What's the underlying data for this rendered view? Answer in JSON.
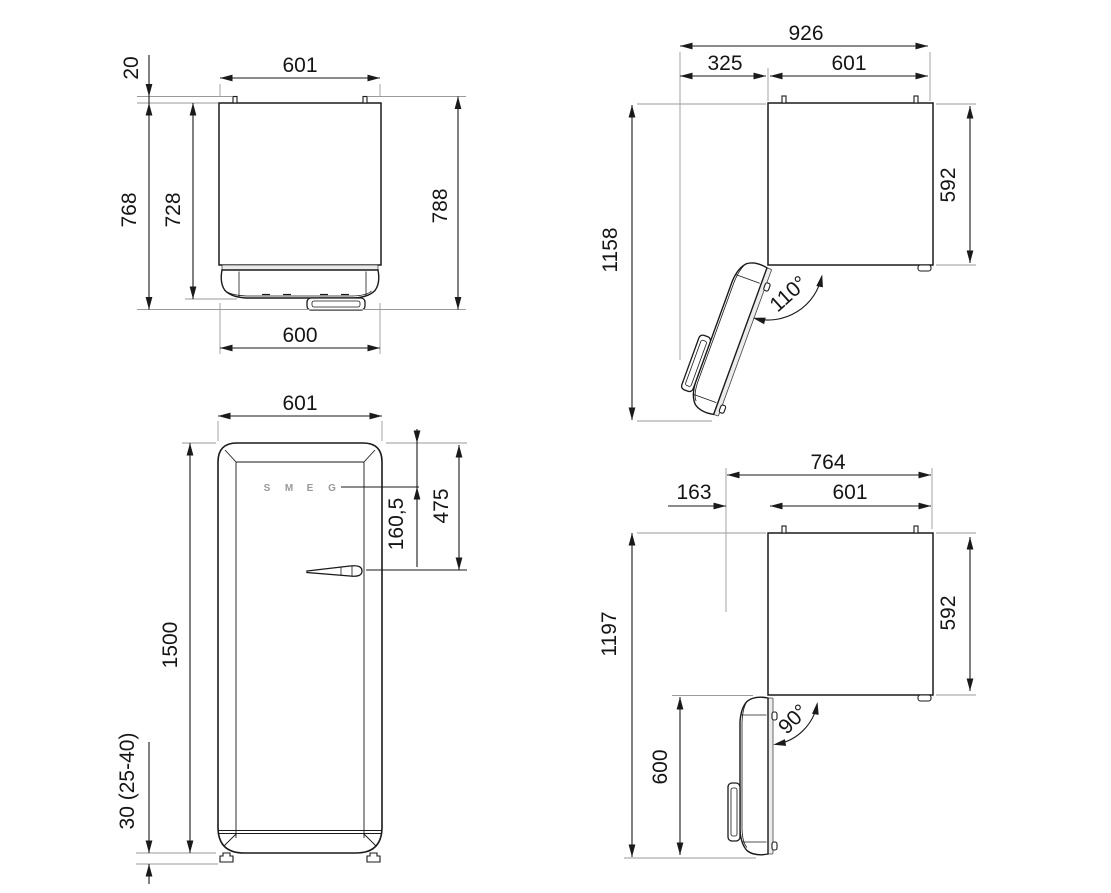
{
  "page": {
    "background": "#ffffff",
    "line_color": "#1a1a1a",
    "ext_line_color": "#9a9a9a",
    "subject": "refrigerator dimension drawing, four views"
  },
  "diagram": {
    "views": {
      "top_closed": {
        "title": "top view, door closed",
        "dims": {
          "width": "601",
          "rear_spacer": "20",
          "depth_with_handle": "768",
          "depth_body": "728",
          "depth_total": "788",
          "door_width": "600"
        }
      },
      "top_open_110": {
        "title": "top view, door open 110 degrees",
        "dims": {
          "width_overall": "926",
          "door_swing": "325",
          "width": "601",
          "depth_open": "1158",
          "depth_cabinet": "592",
          "angle": "110°"
        }
      },
      "front": {
        "title": "front view",
        "dims": {
          "width": "601",
          "height": "1500",
          "logo_from_top": "160,5",
          "handle_from_top": "475",
          "feet_height": "30 (25-40)"
        },
        "logo": [
          "S",
          "M",
          "E",
          "G"
        ]
      },
      "top_open_90": {
        "title": "top view, door open 90 degrees",
        "dims": {
          "width_overall": "764",
          "door_protrusion": "163",
          "width": "601",
          "depth_open": "1197",
          "depth_cabinet": "592",
          "door_width": "600",
          "angle": "90°"
        }
      }
    }
  }
}
